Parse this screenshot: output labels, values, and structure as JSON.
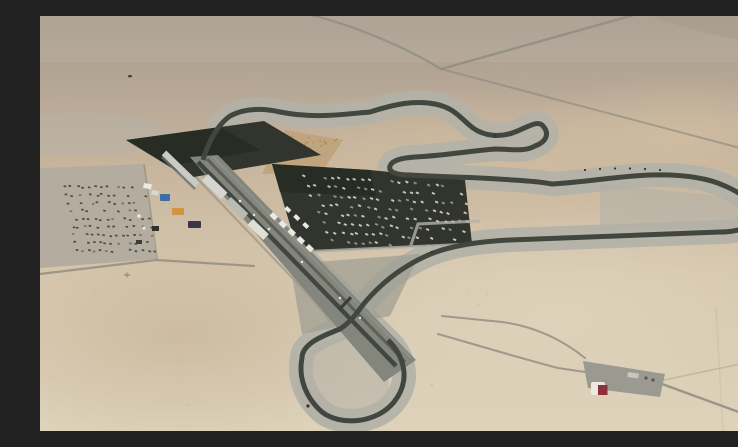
{
  "scene": {
    "type": "aerial-photograph",
    "subject": "Aerial view of a desert motor-racing circuit complex (Losail-style) in flat sandy terrain",
    "time_of_day": "daytime, hazy",
    "features": [
      "hazy desert horizon across the top",
      "winding dark asphalt race track with pale grey runoff areas",
      "long diagonal start-finish straight with pit lane and pit buildings",
      "large dark paddock car park filled with parked vehicles",
      "western spectator parking lot with rows of cars",
      "dark rectangular overflow parking pad north-west of the pits",
      "triangular brown gravel trap beside the northern esses",
      "right-hand hairpin loop on the east side",
      "bottom 180-degree final corner loop",
      "thin access roads crossing the desert",
      "small entrance-gate facility with a red-roofed building at lower right",
      "colourful service trucks (blue, orange) west of the pit straight"
    ]
  },
  "palette": {
    "desertFar": "#a89b8d",
    "desertUpper": "#b5a695",
    "desertMid": "#c7b49d",
    "sandLight": "#d6c8ae",
    "sandPale": "#ded2bb",
    "sandWarm": "#d0bda1",
    "farDarkPatch": "#9c8e7e",
    "runoff": "#b3b1a7",
    "runoffDark": "#9d9c92",
    "track": "#41463f",
    "band": "#84867d",
    "bandLane": "#5c6057",
    "lotDark": "#31352d",
    "lotDarker": "#262a23",
    "westLot": "#b4ad9f",
    "road": "#8e8b7f",
    "white": "#eaeae3",
    "buildingGrey": "#c9ccc5",
    "redBuilding": "#8e3039",
    "blueTruck": "#3e6da5",
    "orangeTruck": "#d29440",
    "gravel": "#bfa37c",
    "gravelDot": "#8b7351",
    "carLight": "#dfe0d9",
    "carGrey": "#9aa096",
    "carDark": "#3f4138"
  }
}
